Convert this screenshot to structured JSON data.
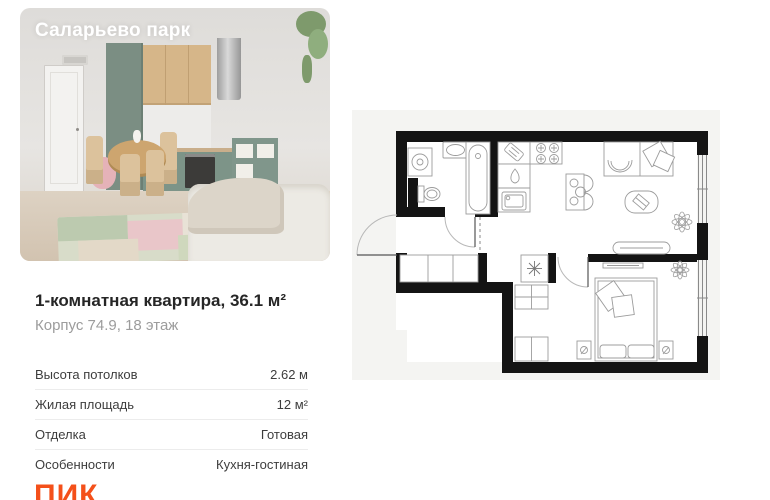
{
  "card": {
    "project_title": "Саларьево парк",
    "headline": "1-комнатная квартира, 36.1 м²",
    "subline": "Корпус 74.9, 18 этаж",
    "specs": [
      {
        "label": "Высота потолков",
        "value": "2.62 м"
      },
      {
        "label": "Жилая площадь",
        "value": "12 м²"
      },
      {
        "label": "Отделка",
        "value": "Готовая"
      },
      {
        "label": "Особенности",
        "value": "Кухня-гостиная"
      }
    ],
    "brand_logo": "ПИК"
  },
  "colors": {
    "brand_orange": "#f4501a",
    "heading": "#262626",
    "subline_gray": "#9c9c9c",
    "divider": "#ececec",
    "plan_walls": "#141414"
  },
  "floorplan": {
    "kind": "apartment-floor-plan",
    "rooms": [
      "bathroom",
      "kitchen",
      "living-room",
      "bedroom",
      "hallway"
    ]
  }
}
